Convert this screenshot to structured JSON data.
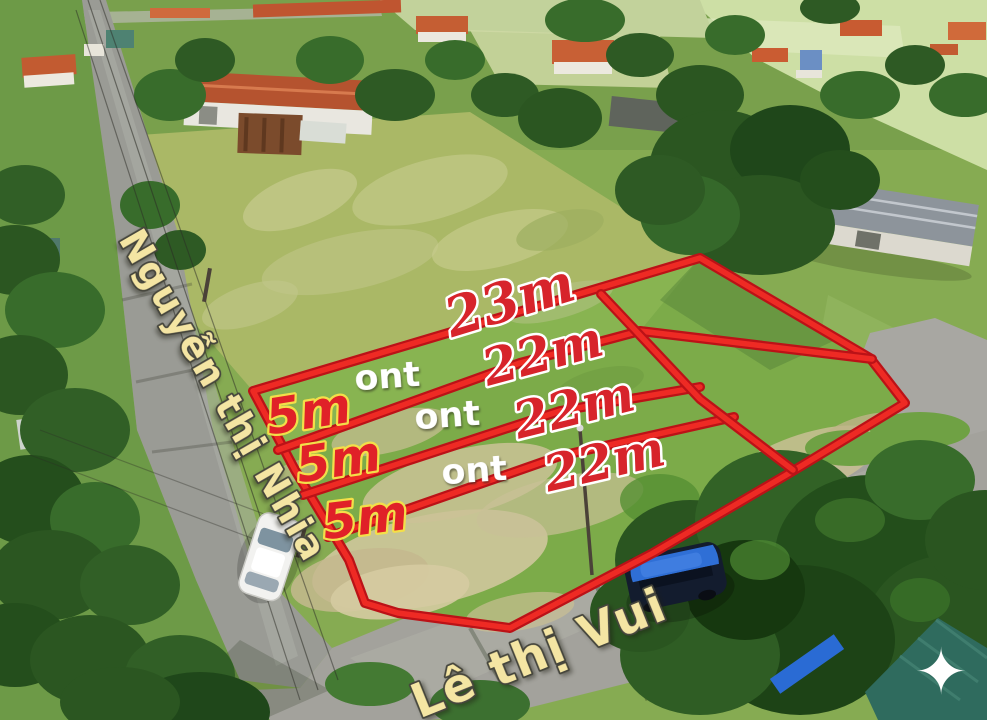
{
  "streets": {
    "left": "Nguyễn thị Nhia",
    "bottom": "Lê thị Vui"
  },
  "plot": {
    "depth_top": "23m",
    "depths": [
      "22m",
      "22m",
      "22m"
    ],
    "frontages": [
      "5m",
      "5m",
      "5m"
    ],
    "zonings": [
      "ont",
      "ont",
      "ont"
    ]
  },
  "icons": {
    "sparkle": "✦"
  },
  "colors": {
    "boundary_red": "#ee2a24",
    "dimension_text_red": "#d7242b",
    "dimension_outline_white": "#ffffff",
    "frontage_outline_yellow": "#f3df49",
    "zoning_text_white": "#ffffff",
    "street_text_cream": "#f4e5a3"
  }
}
